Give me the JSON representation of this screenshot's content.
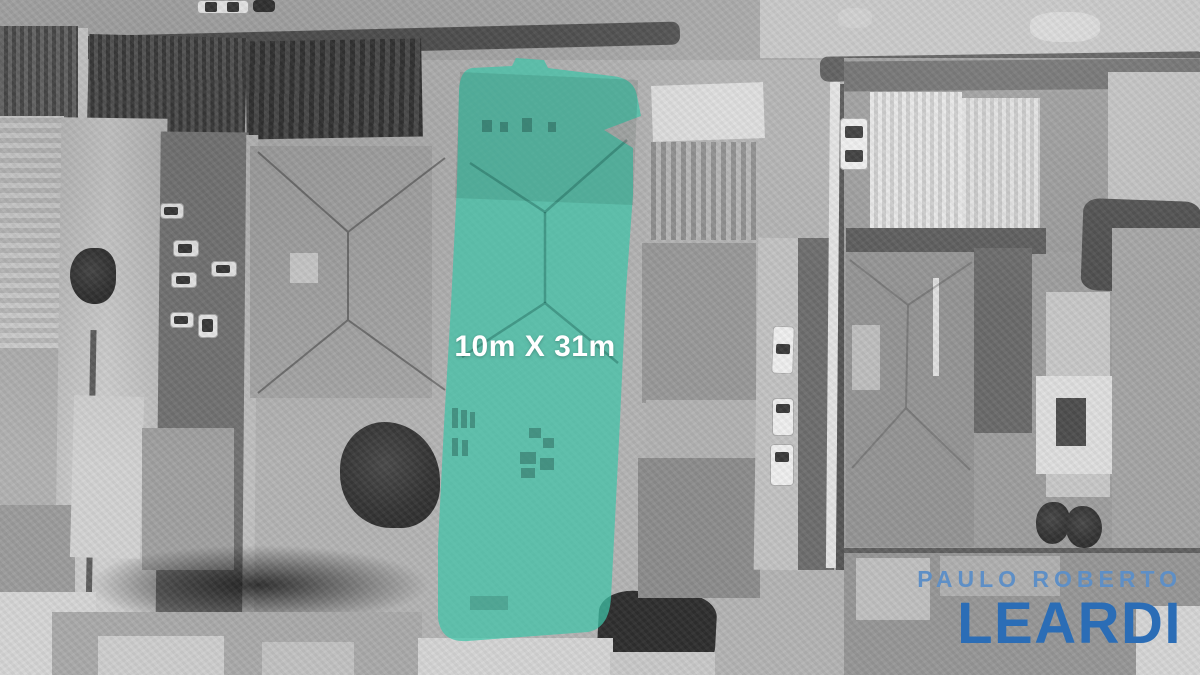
{
  "scene": {
    "description": "Grayscale aerial satellite photo of a dense urban block with one property lot highlighted in teal",
    "lot": {
      "label": "10m X 31m",
      "width_m": 10,
      "depth_m": 31
    }
  },
  "logo": {
    "line1": "PAULO ROBERTO",
    "line2": "LEARDI"
  },
  "colors": {
    "lot_fill": "rgba(62,196,168,0.72)",
    "label_text": "#ffffff",
    "logo_line1": "#5e8fc6",
    "logo_line2": "#2b6db6"
  }
}
